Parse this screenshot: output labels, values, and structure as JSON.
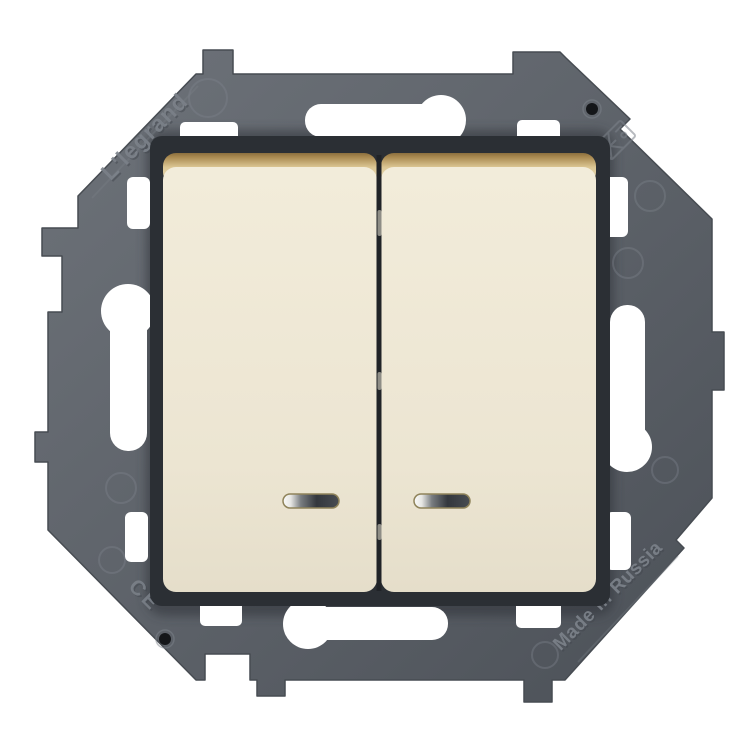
{
  "image": {
    "type": "product-photo",
    "subject": "Two-gang illuminated rocker light switch (ivory) mounted on grey mounting frame",
    "background_color": "#ffffff"
  },
  "frame": {
    "brand_text": "L'legrand",
    "origin_text": "Made in Russia",
    "cert_text": "CE",
    "markings": {
      "screw_holes": 2,
      "keyhole_slots": 4,
      "symbol": "crossed-square-marking"
    },
    "colors": {
      "body_light": "#6e737a",
      "body": "#5f646b",
      "body_dark": "#4b5057",
      "emboss": "#7d838b",
      "emboss_shadow": "#42474e",
      "screw_hole": "#141619",
      "shadow": "#2e3237"
    }
  },
  "switch": {
    "rockers": [
      {
        "id": "left",
        "indicator_lens": true
      },
      {
        "id": "right",
        "indicator_lens": true
      }
    ],
    "colors": {
      "frame_dark": "#2b2f34",
      "seam": "#202327",
      "glint": "#eae6d6",
      "rocker_top": "#f2ecda",
      "rocker_mid": "#ece5d2",
      "rocker_bottom": "#e5deca",
      "bevel_line": "#8a6f3e",
      "bevel_mid": "#a8884f",
      "bevel_pale": "#dcc795",
      "bevel_fade": "#eee3c4",
      "lens_border": "#8f835a",
      "lens_highlight": "#fbfbf9",
      "lens_fade": "#e6e6e3",
      "lens_mid": "#787c80",
      "lens_dark": "#33373d",
      "lens_end": "#484c52"
    }
  }
}
